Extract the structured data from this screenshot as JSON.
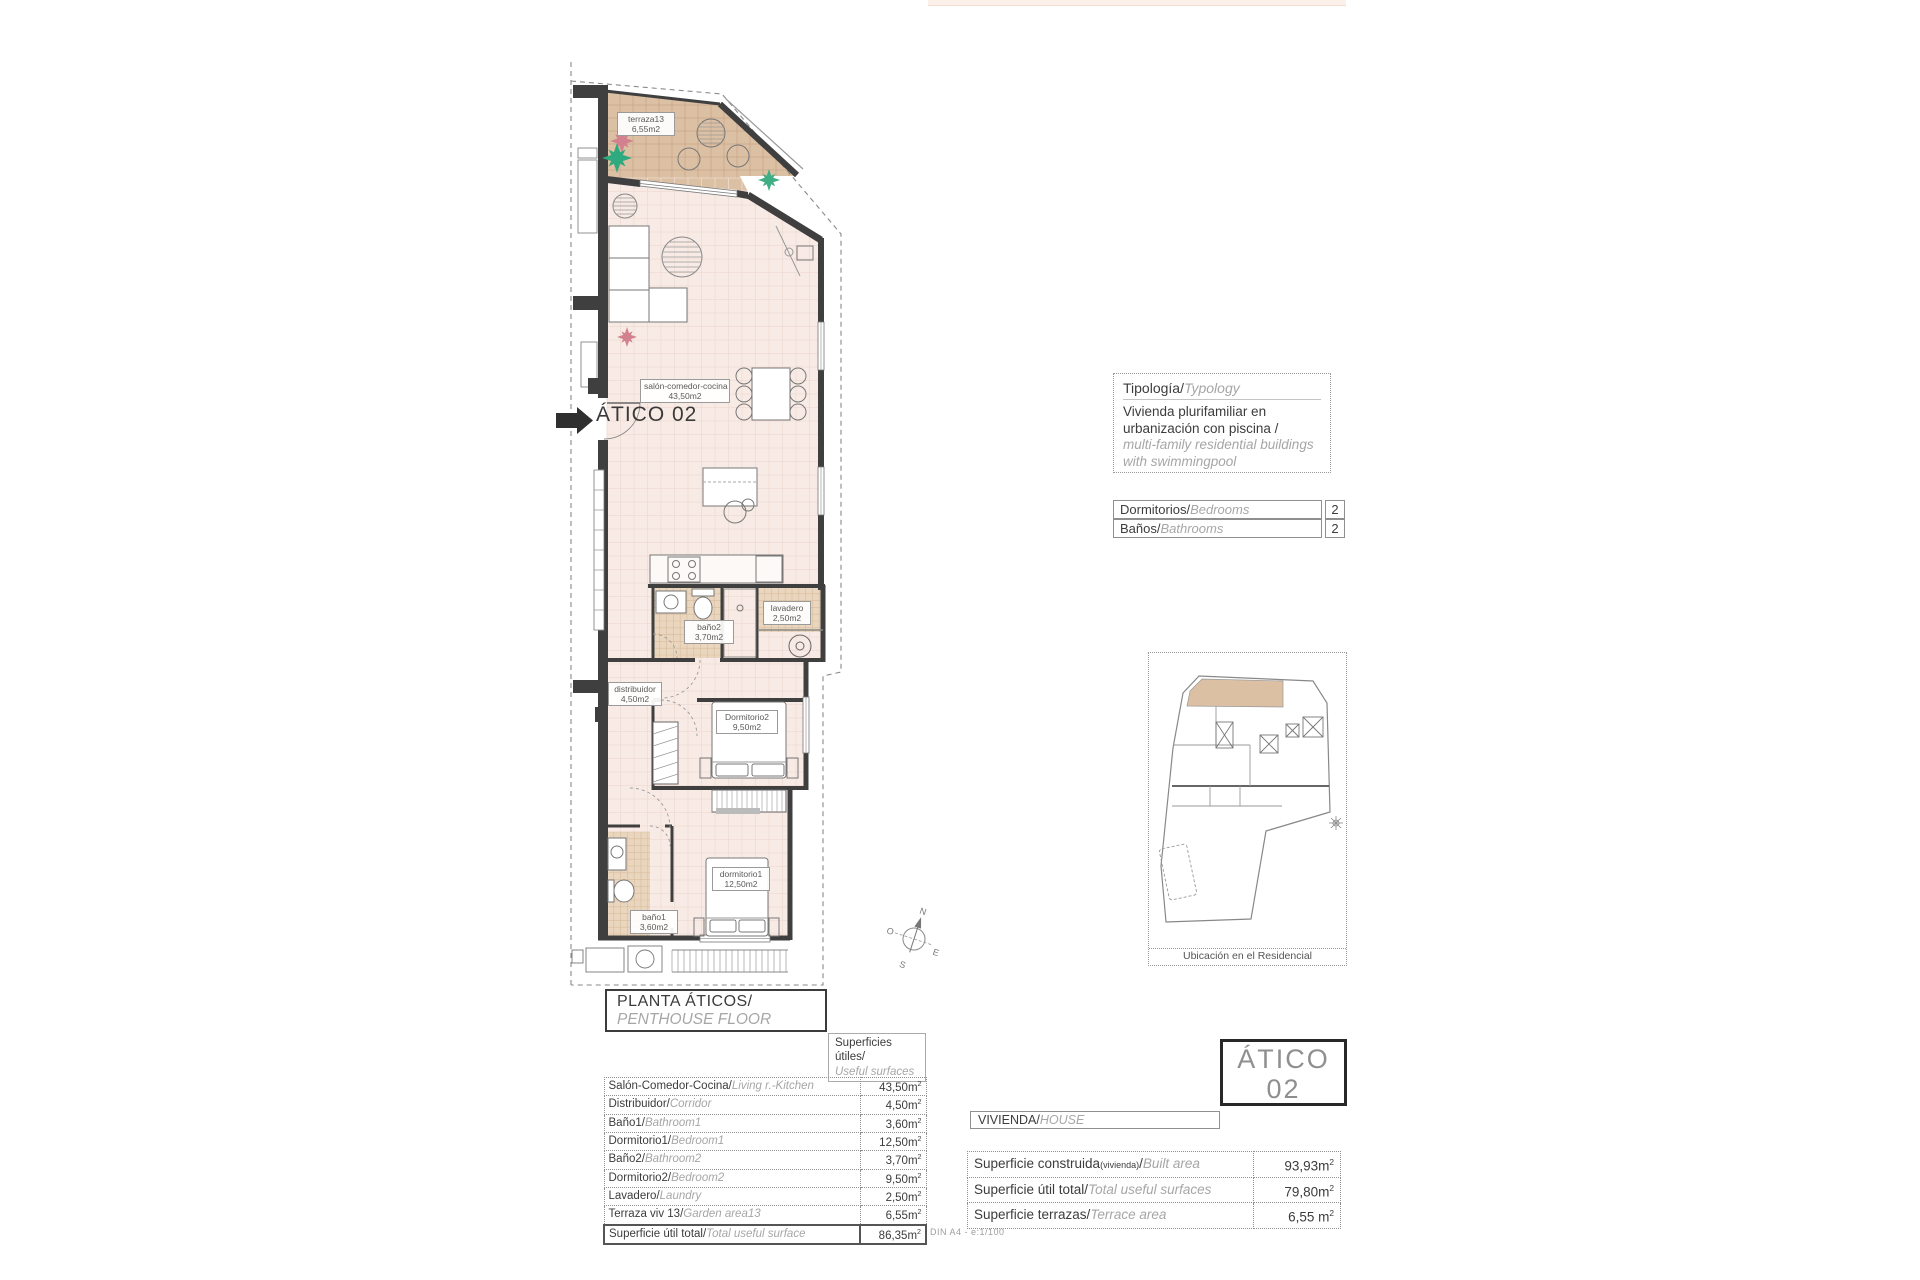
{
  "plan": {
    "arrow_label": "ÁTICO 02",
    "rooms": [
      {
        "name": "terraza13",
        "area": "6,55m2"
      },
      {
        "name": "salón-comedor-cocina",
        "area": "43,50m2"
      },
      {
        "name": "baño2",
        "area": "3,70m2"
      },
      {
        "name": "lavadero",
        "area": "2,50m2"
      },
      {
        "name": "distribuidor",
        "area": "4,50m2"
      },
      {
        "name": "Dormitorio2",
        "area": "9,50m2"
      },
      {
        "name": "dormitorio1",
        "area": "12,50m2"
      },
      {
        "name": "baño1",
        "area": "3,60m2"
      }
    ],
    "compass": {
      "n": "N",
      "e": "E",
      "s": "S",
      "o": "O"
    }
  },
  "typology": {
    "title_es": "Tipología/",
    "title_en": "Typology",
    "body_es": "Vivienda plurifamiliar en urbanización con piscina /",
    "body_en": "multi-family residential buildings with swimmingpool"
  },
  "counts": {
    "rows": [
      {
        "es": "Dormitorios/",
        "en": "Bedrooms",
        "value": "2"
      },
      {
        "es": "Baños/",
        "en": "Bathrooms",
        "value": "2"
      }
    ]
  },
  "location": {
    "caption": "Ubicación en el Residencial"
  },
  "floor_title": {
    "es": "PLANTA ÁTICOS/",
    "en": "PENTHOUSE FLOOR"
  },
  "useful_header": {
    "es": "Superficies útiles/",
    "en": "Useful surfaces"
  },
  "surfaces_table": {
    "rows": [
      {
        "es": "Salón-Comedor-Cocina/",
        "en": "Living r.-Kitchen",
        "value": "43,50m",
        "sup": "2"
      },
      {
        "es": "Distribuidor/",
        "en": "Corridor",
        "value": "4,50m",
        "sup": "2"
      },
      {
        "es": "Baño1/",
        "en": "Bathroom1",
        "value": "3,60m",
        "sup": "2"
      },
      {
        "es": "Dormitorio1/",
        "en": "Bedroom1",
        "value": "12,50m",
        "sup": "2"
      },
      {
        "es": "Baño2/",
        "en": "Bathroom2",
        "value": "3,70m",
        "sup": "2"
      },
      {
        "es": "Dormitorio2/",
        "en": "Bedroom2",
        "value": "9,50m",
        "sup": "2"
      },
      {
        "es": "Lavadero/",
        "en": "Laundry",
        "value": "2,50m",
        "sup": "2"
      },
      {
        "es": "Terraza viv 13/",
        "en": "Garden area13",
        "value": "6,55m",
        "sup": "2"
      },
      {
        "es": "Superficie útil total/",
        "en": "Total useful surface",
        "value": "86,35m",
        "sup": "2"
      }
    ]
  },
  "unit_box": {
    "line1": "ÁTICO",
    "line2": "02"
  },
  "vivienda_bar": {
    "es": "VIVIENDA/",
    "en": "HOUSE"
  },
  "house_table": {
    "rows": [
      {
        "es": "Superficie construida",
        "note": "(vivienda)",
        "slash": "/",
        "en": "Built area",
        "value": "93,93m",
        "sup": "2"
      },
      {
        "es": "Superficie útil total/",
        "note": "",
        "slash": "",
        "en": "Total useful surfaces",
        "value": "79,80m",
        "sup": "2"
      },
      {
        "es": "Superficie terrazas/",
        "note": "",
        "slash": "",
        "en": "Terrace area",
        "value": "6,55 m",
        "sup": "2"
      }
    ]
  },
  "footer": {
    "scale": "DIN A4 - e:1/100"
  }
}
